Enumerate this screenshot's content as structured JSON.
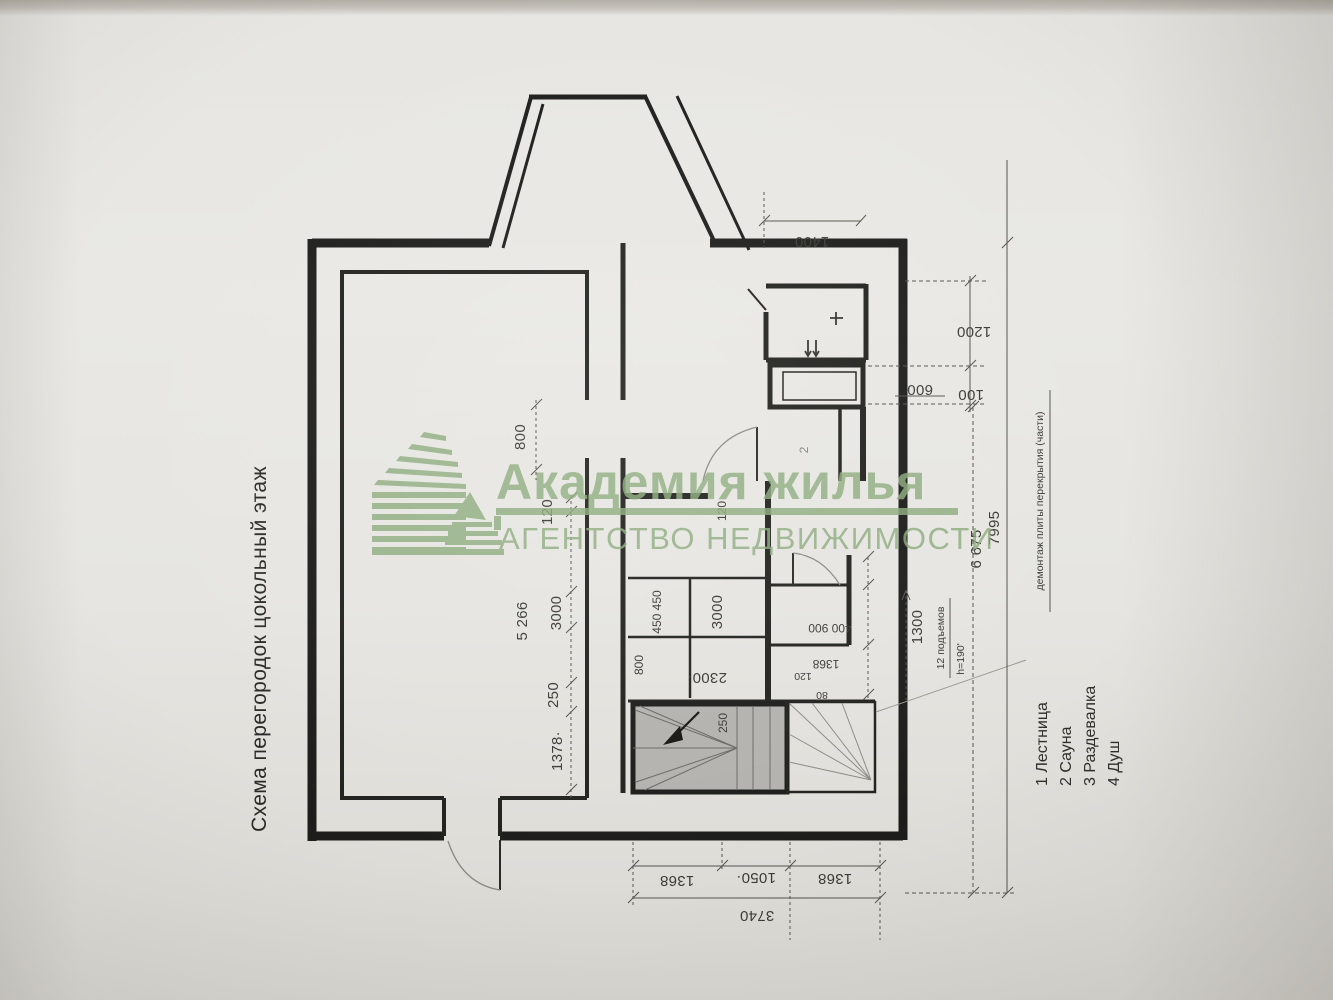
{
  "title": "Схема перегородок цокольный этаж",
  "watermark": {
    "brand": "Академия жилья",
    "subtitle": "АГЕНТСТВО НЕДВИЖИМОСТИ",
    "color": "#8cab7c"
  },
  "legend": {
    "item1": "1 Лестница",
    "item2": "2 Сауна",
    "item3": "3 Раздевалка",
    "item4": "4 Душ"
  },
  "annotations": {
    "demolition_note": "демонтаж плиты перекрытия (части)",
    "stairs_risers": "12 подъемов",
    "riser_height": "h=190'",
    "room_number_faint": "2"
  },
  "dims": {
    "top_offset": "1400",
    "right_1200": "1200",
    "right_100": "100",
    "closet_600": "600",
    "right_total": "7995",
    "right_inner": "6 675",
    "left_800": "800",
    "left_120": "120",
    "left_5266": "5 266",
    "left_3000": "3000",
    "left_250": "250",
    "left_1378": "1378·",
    "sauna_120": "120",
    "sauna_450": "450 450",
    "sauna_3000": "3000",
    "sauna_800": "800",
    "sauna_2300": "2300·",
    "room3_400_900": "400 900",
    "room3_1368": "1368",
    "room3_120": "120",
    "room3_80": "80",
    "stair_1300": "1300",
    "stair_250": "250",
    "bottom_1368a": "1368",
    "bottom_1050": "1050·",
    "bottom_1368b": "1368",
    "bottom_total": "3740"
  }
}
